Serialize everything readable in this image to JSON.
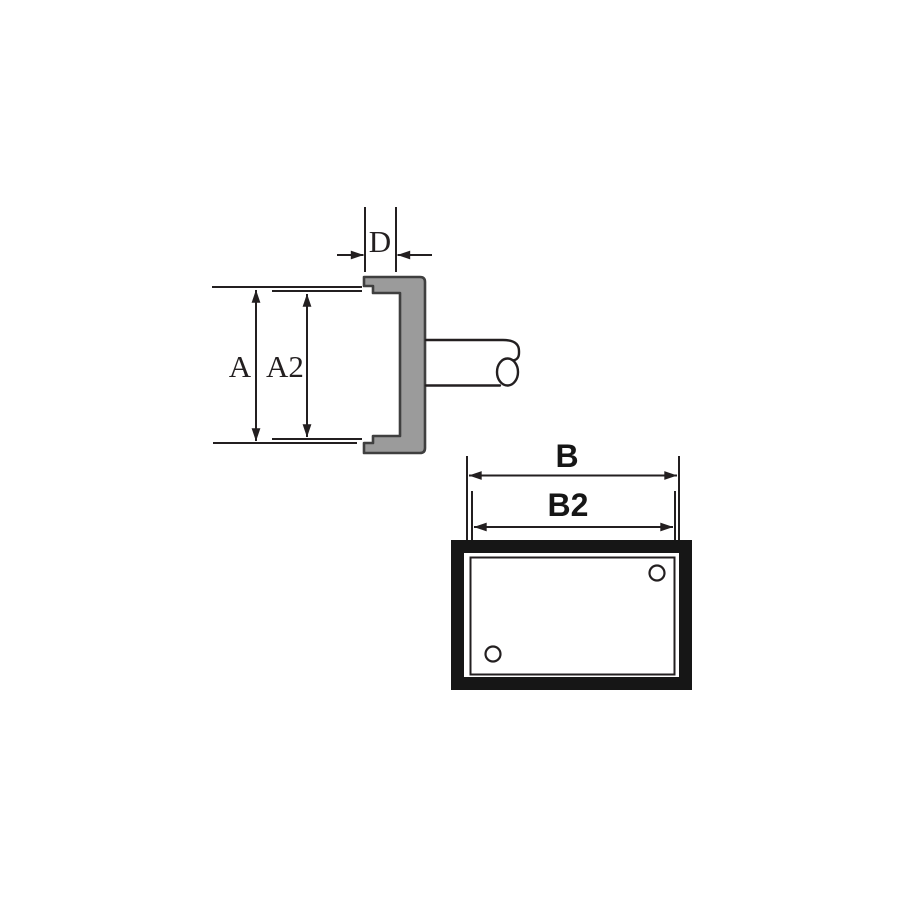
{
  "colors": {
    "background": "#ffffff",
    "line": "#231f20",
    "part_fill": "#9b9b9b",
    "part_outline": "#3f3f3f",
    "solid_black": "#161616"
  },
  "diagram": {
    "side_view": {
      "dimensions": {
        "a": "A",
        "a2": "A2",
        "d": "D"
      }
    },
    "front_view": {
      "dimensions": {
        "b": "B",
        "b2": "B2"
      }
    }
  }
}
